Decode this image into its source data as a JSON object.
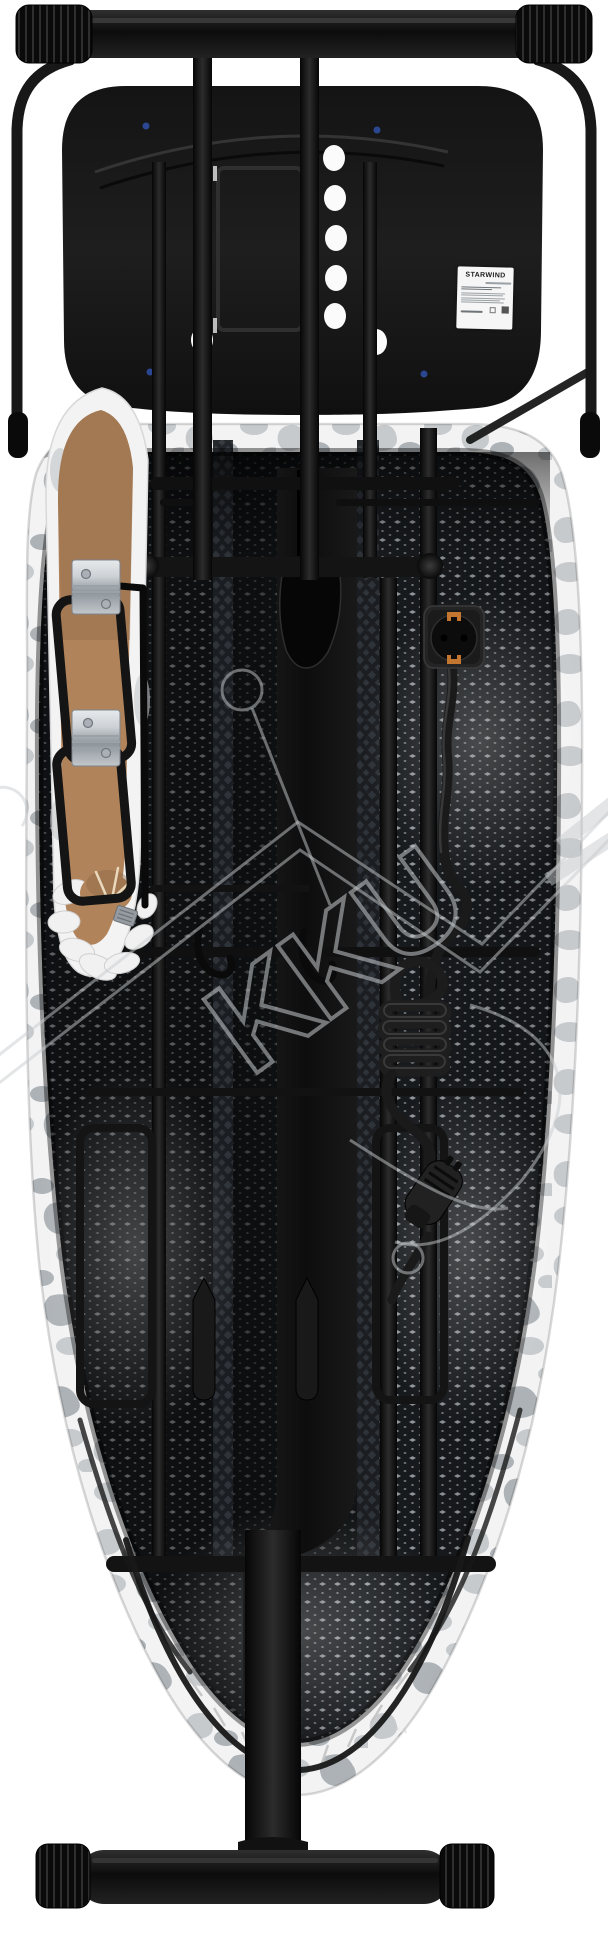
{
  "label": {
    "brand": "STARWIND"
  },
  "watermark": {
    "text": "KKU"
  },
  "colors": {
    "bg": "#ffffff",
    "frame": "#181818",
    "frame-deep": "#0a0a0a",
    "frame-hi": "#3a3a3a",
    "tray": "#1b1b1b",
    "mesh-light": "#a9afb4",
    "mesh-dark": "#1b1e22",
    "seam-bg": "#30353b",
    "fabric-white": "#f3f3f3",
    "fabric-gray": "#c6cacd",
    "fabric-gray2": "#adb2b6",
    "brown": "#b1835b",
    "brown-dark": "#8a6647",
    "silver": "#cdd2d6",
    "silver-dark": "#8e959b",
    "copper": "#c2762f",
    "label-bg": "#f6f6f6",
    "label-text": "#1d1d1d",
    "watermark": "#c7cbce",
    "screw-blue": "#2e4d9e"
  }
}
